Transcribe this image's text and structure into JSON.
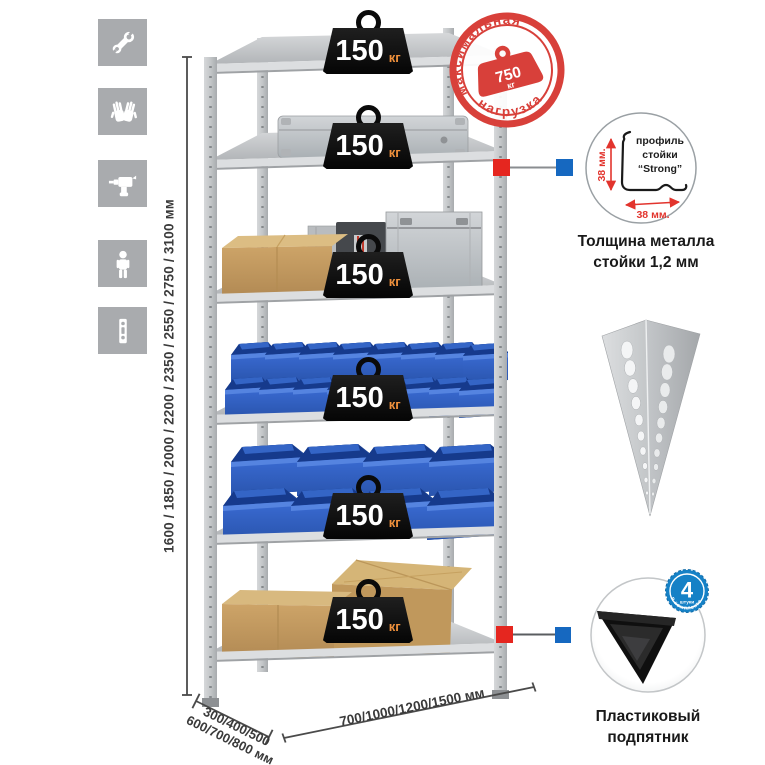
{
  "canvas": {
    "background": "#ffffff"
  },
  "left_icons": {
    "tile_color": "#a9abae",
    "items": [
      "wrench-icon",
      "gloves-icon",
      "drill-icon",
      "person-icon",
      "perforated-post-icon"
    ]
  },
  "rack": {
    "shelf_count": 6,
    "load": {
      "value": "150",
      "unit": "кг"
    }
  },
  "max_load_stamp": {
    "arc_top": "максимальная",
    "arc_bottom": "нагрузка",
    "value": "750",
    "unit": "кг",
    "color": "#d8403a"
  },
  "dimensions": {
    "height": "1600 / 1850 / 2000 / 2200 / 2350 / 2550 / 2750 / 3100 мм",
    "depth_line1": "300/400/500",
    "depth_line2": "600/700/800 мм",
    "width": "700/1000/1200/1500 мм"
  },
  "profile_detail": {
    "line1": "профиль",
    "line2": "стойки",
    "line3": "“Strong”",
    "dim_vertical": "38 мм.",
    "dim_horizontal": "38 мм.",
    "caption1": "Толщина металла",
    "caption2": "стойки 1,2 мм",
    "accent_color": "#e2342d"
  },
  "foot_detail": {
    "badge_value": "4",
    "badge_unit": "штуки",
    "badge_arc": "в комплекте",
    "badge_color": "#1581c6",
    "caption1": "Пластиковый",
    "caption2": "подпятник"
  },
  "callout_markers": {
    "red": "#e5261f",
    "blue": "#1668c0"
  }
}
